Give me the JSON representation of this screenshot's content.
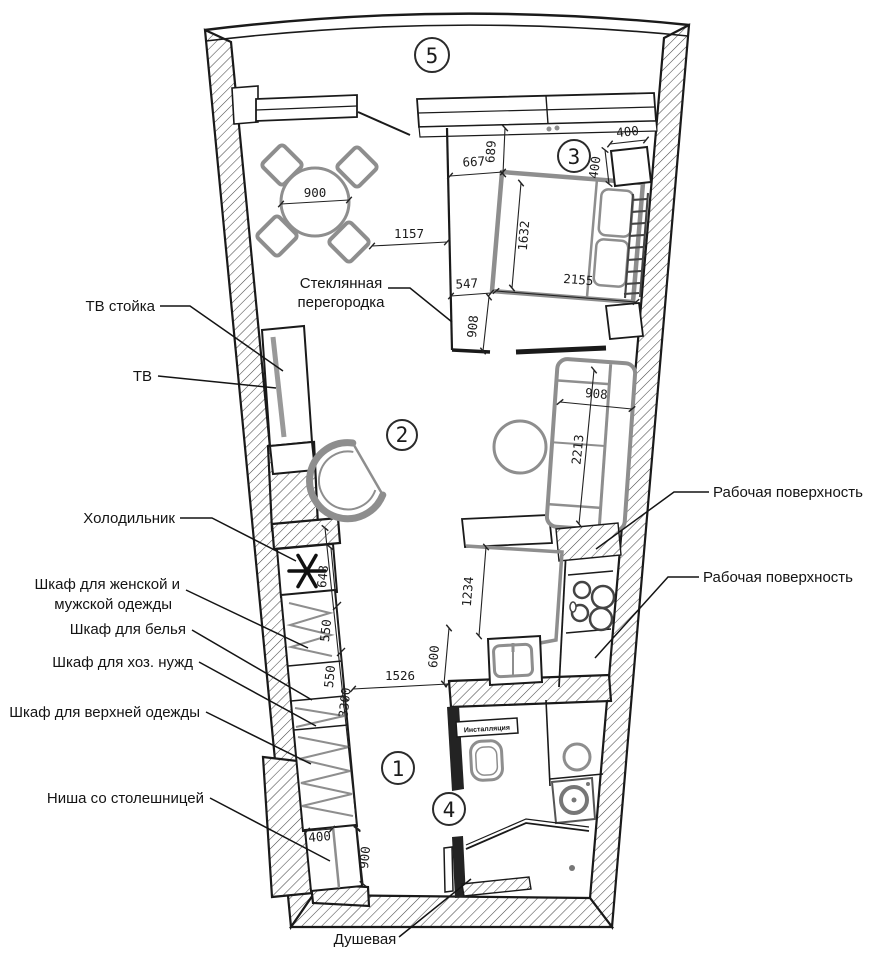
{
  "rooms": [
    "5",
    "3",
    "2",
    "1",
    "4"
  ],
  "labels": {
    "tv_stand": "ТВ стойка",
    "tv": "ТВ",
    "fridge": "Холодильник",
    "wardrobe_main_1": "Шкаф для женской и",
    "wardrobe_main_2": "мужской одежды",
    "wardrobe_linen": "Шкаф для белья",
    "wardrobe_household": "Шкаф для хоз. нужд",
    "wardrobe_outer": "Шкаф для верхней одежды",
    "niche": "Ниша со столешницей",
    "glass_partition_1": "Стеклянная",
    "glass_partition_2": "перегородка",
    "worktop_upper": "Рабочая поверхность",
    "worktop_lower": "Рабочая поверхность",
    "shower": "Душевая",
    "toilet_installation": "Инсталляция"
  },
  "dims": {
    "table": "900",
    "window_to_bed": "689",
    "partition_to_bed": "667",
    "nightstand_w": "400",
    "nightstand_d": "400",
    "partition_offset": "1157",
    "bed_width": "1632",
    "bed_length": "2155",
    "bed_gap": "547",
    "bed_to_wall": "908",
    "sofa_width": "908",
    "sofa_length": "2213",
    "kitchen_run": "1234",
    "sink_depth": "600",
    "hall_width": "1526",
    "wardrobe_run": "3300",
    "fridge_w": "648",
    "shelf_a": "550",
    "shelf_b": "550",
    "niche_w": "400",
    "niche_d": "900"
  },
  "colors": {
    "line": "#1a1a1a",
    "furniture": "#8e8e8e",
    "hatch": "#4a4a4a",
    "text": "#1b1b1b"
  }
}
